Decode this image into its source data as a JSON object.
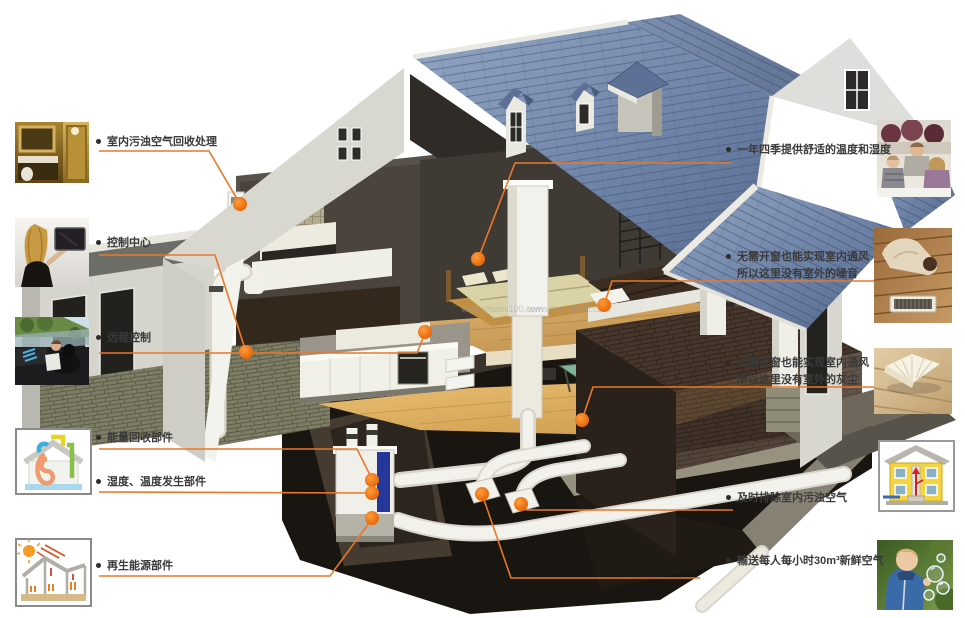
{
  "page": {
    "background": "#FFFFFF",
    "watermark": "www.shushi100.com",
    "description_type": "home-fresh-air-system-cutaway-diagram"
  },
  "colors": {
    "accent": "#E8782A",
    "dot_center": "#FF9C3E",
    "dot_edge": "#E25F00",
    "label_text": "#3A3A3A",
    "watermark": "#99A0A6",
    "roof_blue": "#6E83A8",
    "wall_cream": "#DCDBD3",
    "basement_dark": "#191511",
    "pipe_white": "#F2F1EB",
    "unit_stripe_blue": "#26379C"
  },
  "left_callouts": [
    {
      "label": "室内污浊空气回收处理",
      "image": "bathroom-interior-photo"
    },
    {
      "label": "控制中心",
      "image": "control-center-touchscreen-photo"
    },
    {
      "label": "远程控制",
      "image": "remote-control-driving-photo"
    },
    {
      "label": "能量回收部件",
      "image": "energy-recovery-unit-diagram"
    },
    {
      "label": "湿度、温度发生部件",
      "image": "energy-recovery-unit-diagram"
    },
    {
      "label": "再生能源部件",
      "image": "renewable-energy-house-diagram"
    }
  ],
  "right_callouts": [
    {
      "line1": "一年四季提供舒适的温度和湿度",
      "image": "family-living-room-photo"
    },
    {
      "line1": "无需开窗也能实现室内通风",
      "line2": "所以这里没有室外的噪音",
      "image": "resting-on-wood-floor-vent-photo"
    },
    {
      "line1": "无需开窗也能实现室内通风",
      "line2": "所以这里没有室外的灰尘",
      "image": "book-on-wood-floor-photo"
    },
    {
      "line1": "及时排除室内污浊空气",
      "image": "house-exhaust-airflow-diagram"
    },
    {
      "line1": "输送每人每小时30m³新鲜空气",
      "image": "child-blowing-bubbles-photo"
    }
  ]
}
